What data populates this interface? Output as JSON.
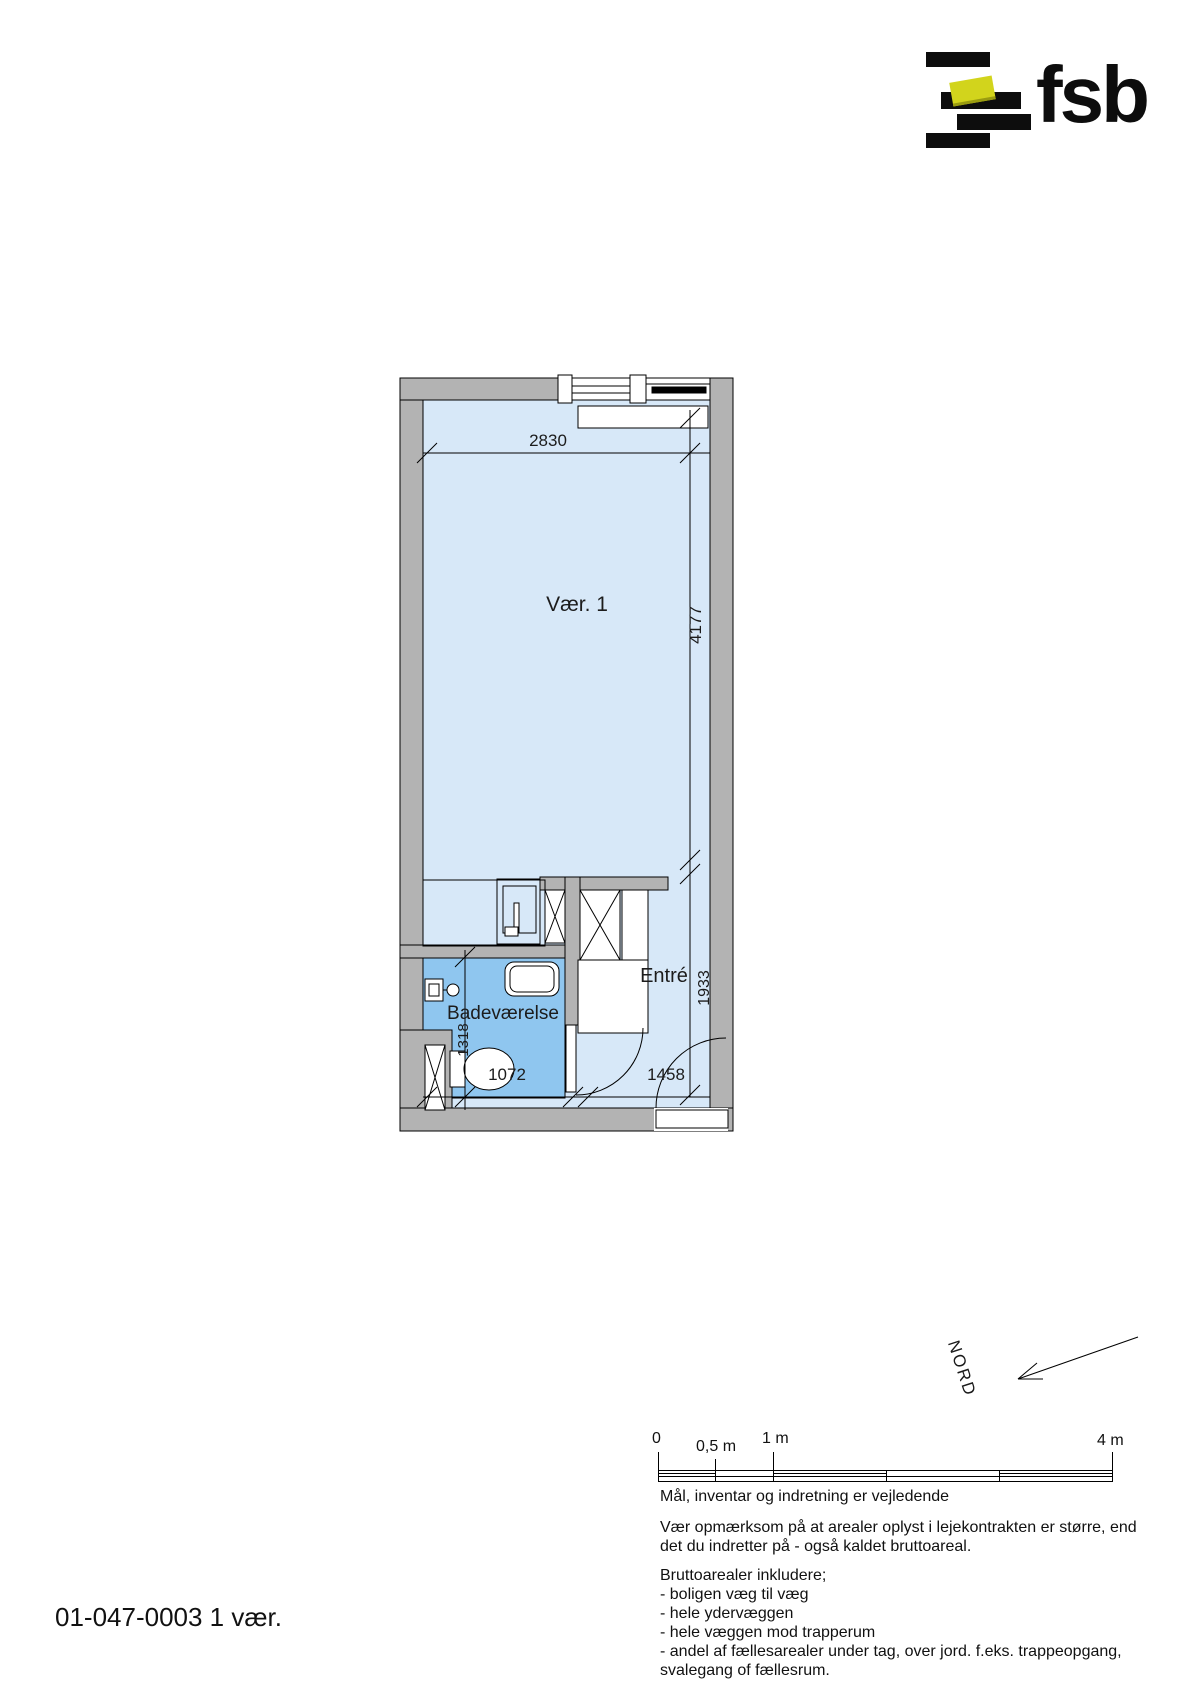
{
  "logo": {
    "text": "fsb",
    "bar_color": "#0d0d0d",
    "accent_color": "#d2d41c"
  },
  "plan": {
    "id": "01-047-0003 1 vær.",
    "rooms": {
      "main": "Vær. 1",
      "bathroom": "Badeværelse",
      "entry": "Entré"
    },
    "dimensions": {
      "top_width": "2830",
      "room_depth": "4177",
      "entry_depth": "1933",
      "bath_depth": "1318",
      "bath_width": "1072",
      "entry_width": "1458"
    },
    "colors": {
      "wall": "#b3b3b3",
      "room_fill": "#d7e8f8",
      "bathroom_fill": "#8fc6ef",
      "line": "#000000",
      "fixture_fill": "#ffffff"
    }
  },
  "north": {
    "label": "NORD"
  },
  "scalebar": {
    "labels": {
      "zero": "0",
      "half": "0,5 m",
      "one": "1 m",
      "four": "4 m"
    }
  },
  "notes": {
    "vejledende": "Mål, inventar og indretning er vejledende",
    "bruttoareal_info": [
      "Vær opmærksom på at arealer oplyst i lejekontrakten er større, end",
      "det du indretter på - også kaldet bruttoareal."
    ],
    "bruttoarealer": [
      "Bruttoarealer inkludere;",
      "- boligen væg til væg",
      "- hele ydervæggen",
      "- hele væggen mod trapperum",
      "- andel af fællesarealer under tag, over jord. f.eks. trappeopgang,",
      "svalegang of fællesrum."
    ]
  }
}
